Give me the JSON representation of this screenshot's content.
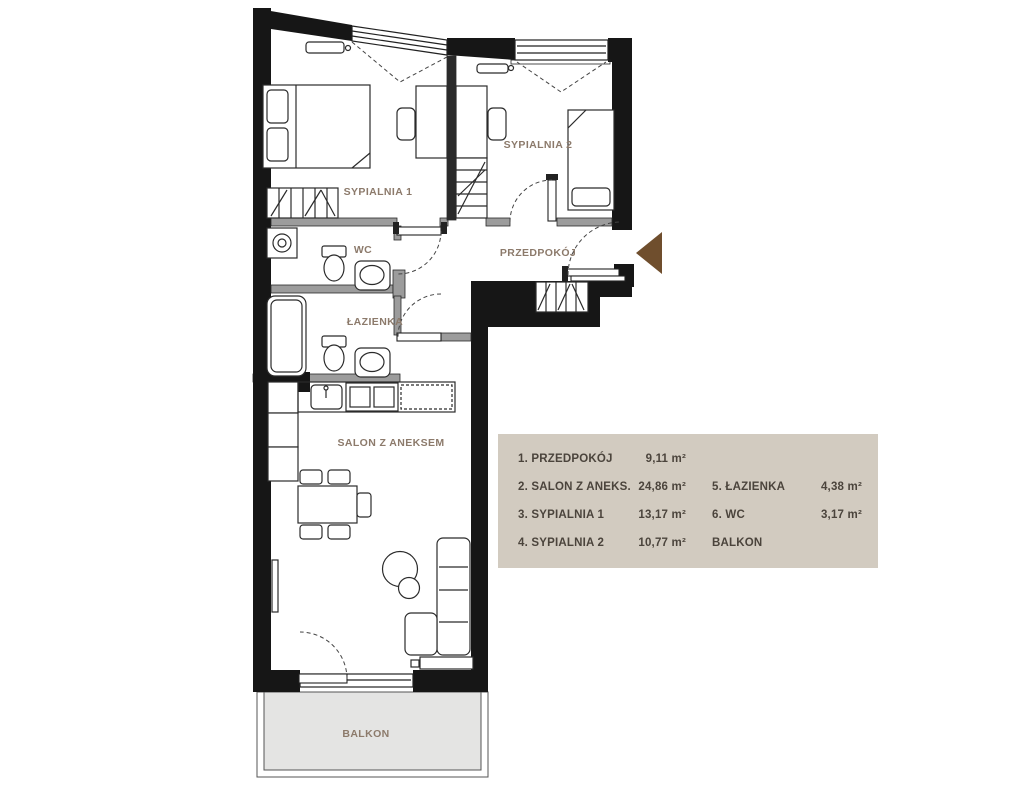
{
  "plan": {
    "rooms": {
      "sypialnia1": "SYPIALNIA 1",
      "sypialnia2": "SYPIALNIA 2",
      "wc": "WC",
      "przedpokoj": "PRZEDPOKÓJ",
      "lazienka": "ŁAZIENKA",
      "salon": "SALON Z ANEKSEM",
      "balkon": "BALKON"
    },
    "colors": {
      "wall": "#161616",
      "partition": "#9c9c9c",
      "room_label": "#8c7a6b",
      "entrance_arrow": "#6f4e2d",
      "balcony_fill": "#e4e4e3",
      "legend_background": "#d2cbc0",
      "legend_text": "#4b443c"
    }
  },
  "legend": {
    "rows": [
      {
        "c1": "1. PRZEDPOKÓJ",
        "v1": "9,11 m²",
        "c2": "",
        "v2": ""
      },
      {
        "c1": "2. SALON Z ANEKS.",
        "v1": "24,86 m²",
        "c2": "5. ŁAZIENKA",
        "v2": "4,38 m²"
      },
      {
        "c1": "3. SYPIALNIA 1",
        "v1": "13,17 m²",
        "c2": "6. WC",
        "v2": "3,17 m²"
      },
      {
        "c1": "4. SYPIALNIA 2",
        "v1": "10,77 m²",
        "c2": "BALKON",
        "v2": ""
      }
    ]
  }
}
